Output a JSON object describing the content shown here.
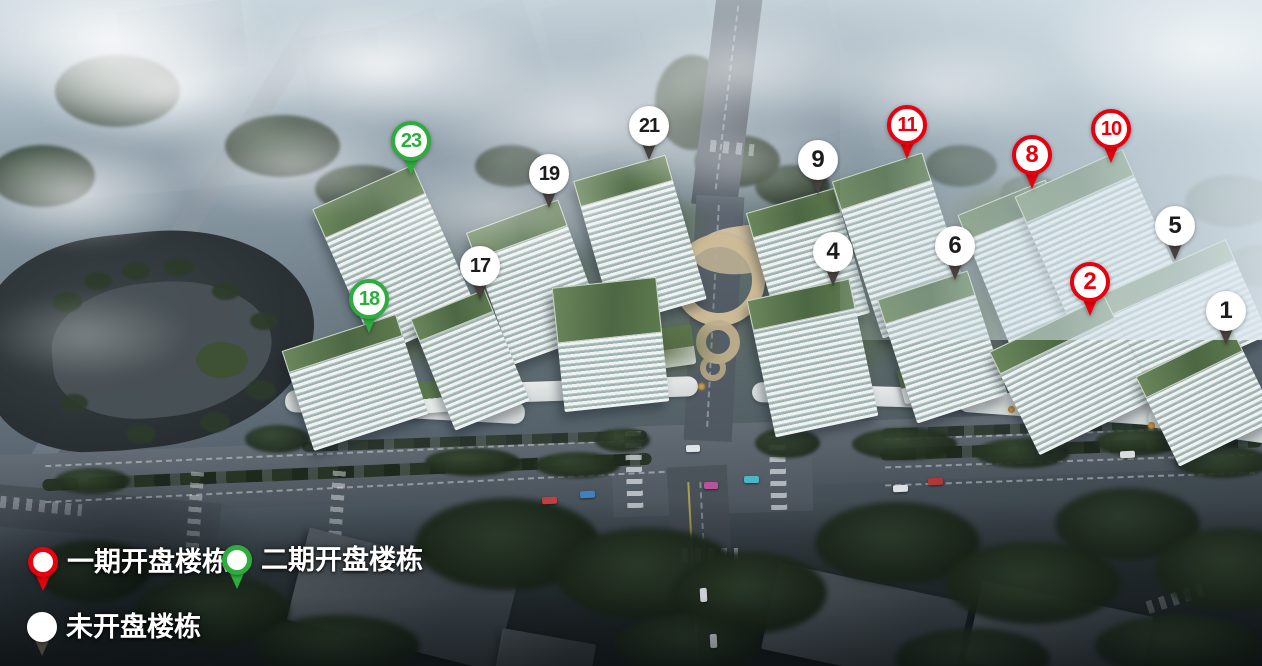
{
  "legend": {
    "items": [
      {
        "key": "phase1",
        "label": "一期开盘楼栋",
        "pin_color": "#e8000f"
      },
      {
        "key": "phase2",
        "label": "二期开盘楼栋",
        "pin_color": "#2fac3e"
      },
      {
        "key": "unopened",
        "label": "未开盘楼栋",
        "pin_color": "#ffffff"
      }
    ]
  },
  "markers": [
    {
      "number": "1",
      "phase": "unopened",
      "x": 1226,
      "y": 311
    },
    {
      "number": "2",
      "phase": "phase1",
      "x": 1090,
      "y": 282
    },
    {
      "number": "4",
      "phase": "unopened",
      "x": 833,
      "y": 252
    },
    {
      "number": "5",
      "phase": "unopened",
      "x": 1175,
      "y": 226
    },
    {
      "number": "6",
      "phase": "unopened",
      "x": 955,
      "y": 246
    },
    {
      "number": "8",
      "phase": "phase1",
      "x": 1032,
      "y": 155
    },
    {
      "number": "9",
      "phase": "unopened",
      "x": 818,
      "y": 160
    },
    {
      "number": "10",
      "phase": "phase1",
      "x": 1111,
      "y": 129
    },
    {
      "number": "11",
      "phase": "phase1",
      "x": 907,
      "y": 125
    },
    {
      "number": "17",
      "phase": "unopened",
      "x": 480,
      "y": 266
    },
    {
      "number": "18",
      "phase": "phase2",
      "x": 369,
      "y": 299
    },
    {
      "number": "19",
      "phase": "unopened",
      "x": 549,
      "y": 174
    },
    {
      "number": "21",
      "phase": "unopened",
      "x": 649,
      "y": 126
    },
    {
      "number": "23",
      "phase": "phase2",
      "x": 411,
      "y": 141
    }
  ],
  "colors": {
    "phase1": "#e8000f",
    "phase2": "#2fac3e",
    "unopened_tail": "#47403d",
    "pin_face": "#ffffff"
  }
}
